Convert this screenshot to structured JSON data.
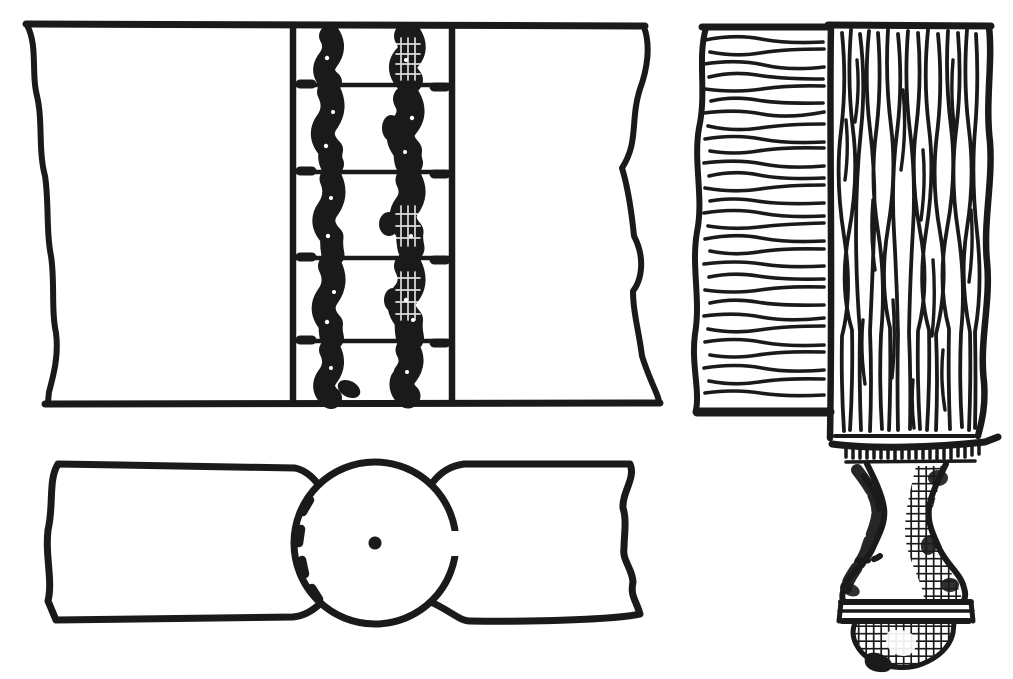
{
  "page": {
    "background_color": "#ffffff",
    "ink_color": "#1a1a1a",
    "title": "Woodworking joint plate"
  },
  "figures": {
    "elevation": {
      "aria": "Knuckle joint between two rails, elevation view with hinge band"
    },
    "plan": {
      "aria": "Knuckle joint, plan view with pivot circle, centre pin and hidden dashed arc"
    },
    "leg": {
      "aria": "Side rail with horizontal grain meeting a square leg with turned foot"
    }
  }
}
